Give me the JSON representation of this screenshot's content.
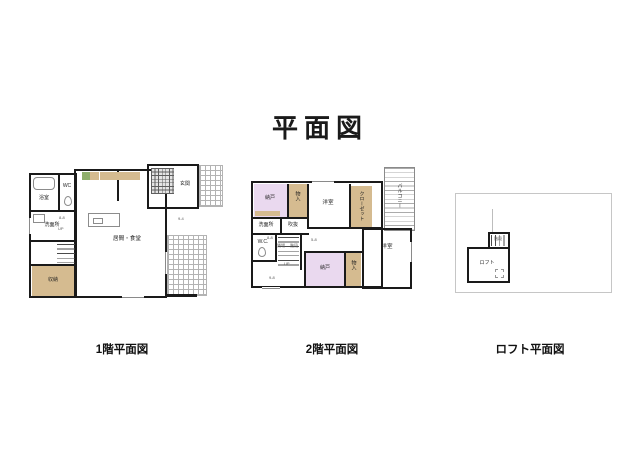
{
  "title": "平面図",
  "floor1": {
    "caption": "1階平面図",
    "labels": {
      "bath": "浴室",
      "wc": "WC",
      "washroom": "洗面所",
      "storage": "収納",
      "living": "居間・食堂",
      "entrance": "玄関",
      "up": "UP"
    },
    "dims": {
      "d1": "8-8",
      "d2": "9-4"
    }
  },
  "floor2": {
    "caption": "2階平面図",
    "labels": {
      "storage_nw": "納戸",
      "closet_nw": "物入",
      "bedroom_n": "洋室",
      "closet_n": "クローゼット",
      "balcony": "バルコニー",
      "washroom": "洗面所",
      "void": "吹抜",
      "wc": "W.C.",
      "landing": "踊場",
      "stairs": "階段",
      "up": "UP",
      "storage_s": "納戸",
      "closet_s": "物入",
      "bedroom_e": "洋室"
    },
    "dims": {
      "d1": "8-8",
      "d2": "5-8",
      "d3": "9-8"
    }
  },
  "loft": {
    "caption": "ロフト平面図",
    "labels": {
      "loft": "ロフト",
      "stairs": "階段"
    }
  },
  "colors": {
    "wall": "#1a1a1a",
    "closet_tan": "#d5bb90",
    "storage_pink": "#ead9ef",
    "kitchen_green": "#8fae6b",
    "tile_line": "#b3b3b3"
  }
}
